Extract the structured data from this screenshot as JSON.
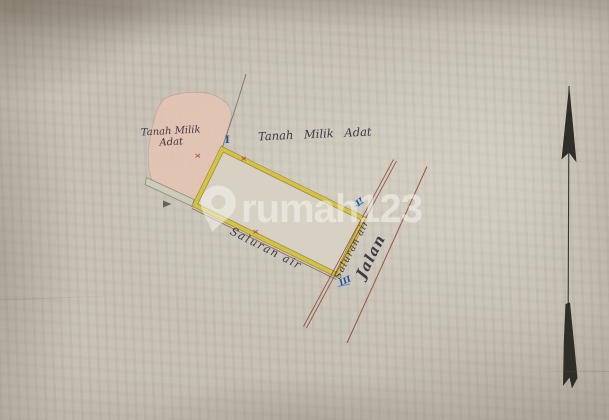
{
  "labels": {
    "plot_left": {
      "line1": "Tanah Milik",
      "line2": "Adat"
    },
    "plot_top": "Tanah Milik Adat",
    "channel_bottom": "Saluran air",
    "channel_right": "Saluran air",
    "road": "Jalan"
  },
  "markers": {
    "north": "I",
    "east": "II",
    "south": "III"
  },
  "watermark": "rumah123",
  "colors": {
    "paper": "#c7c1b5",
    "parcel_yellow": "#d4c240",
    "pink_area": "#e4c4b3",
    "road_line": "#8d4b3a",
    "marker_blue": "#1d4f9e",
    "tick_red": "#b5412f",
    "ink": "#35333b",
    "watermark": "#f6f4ee"
  }
}
